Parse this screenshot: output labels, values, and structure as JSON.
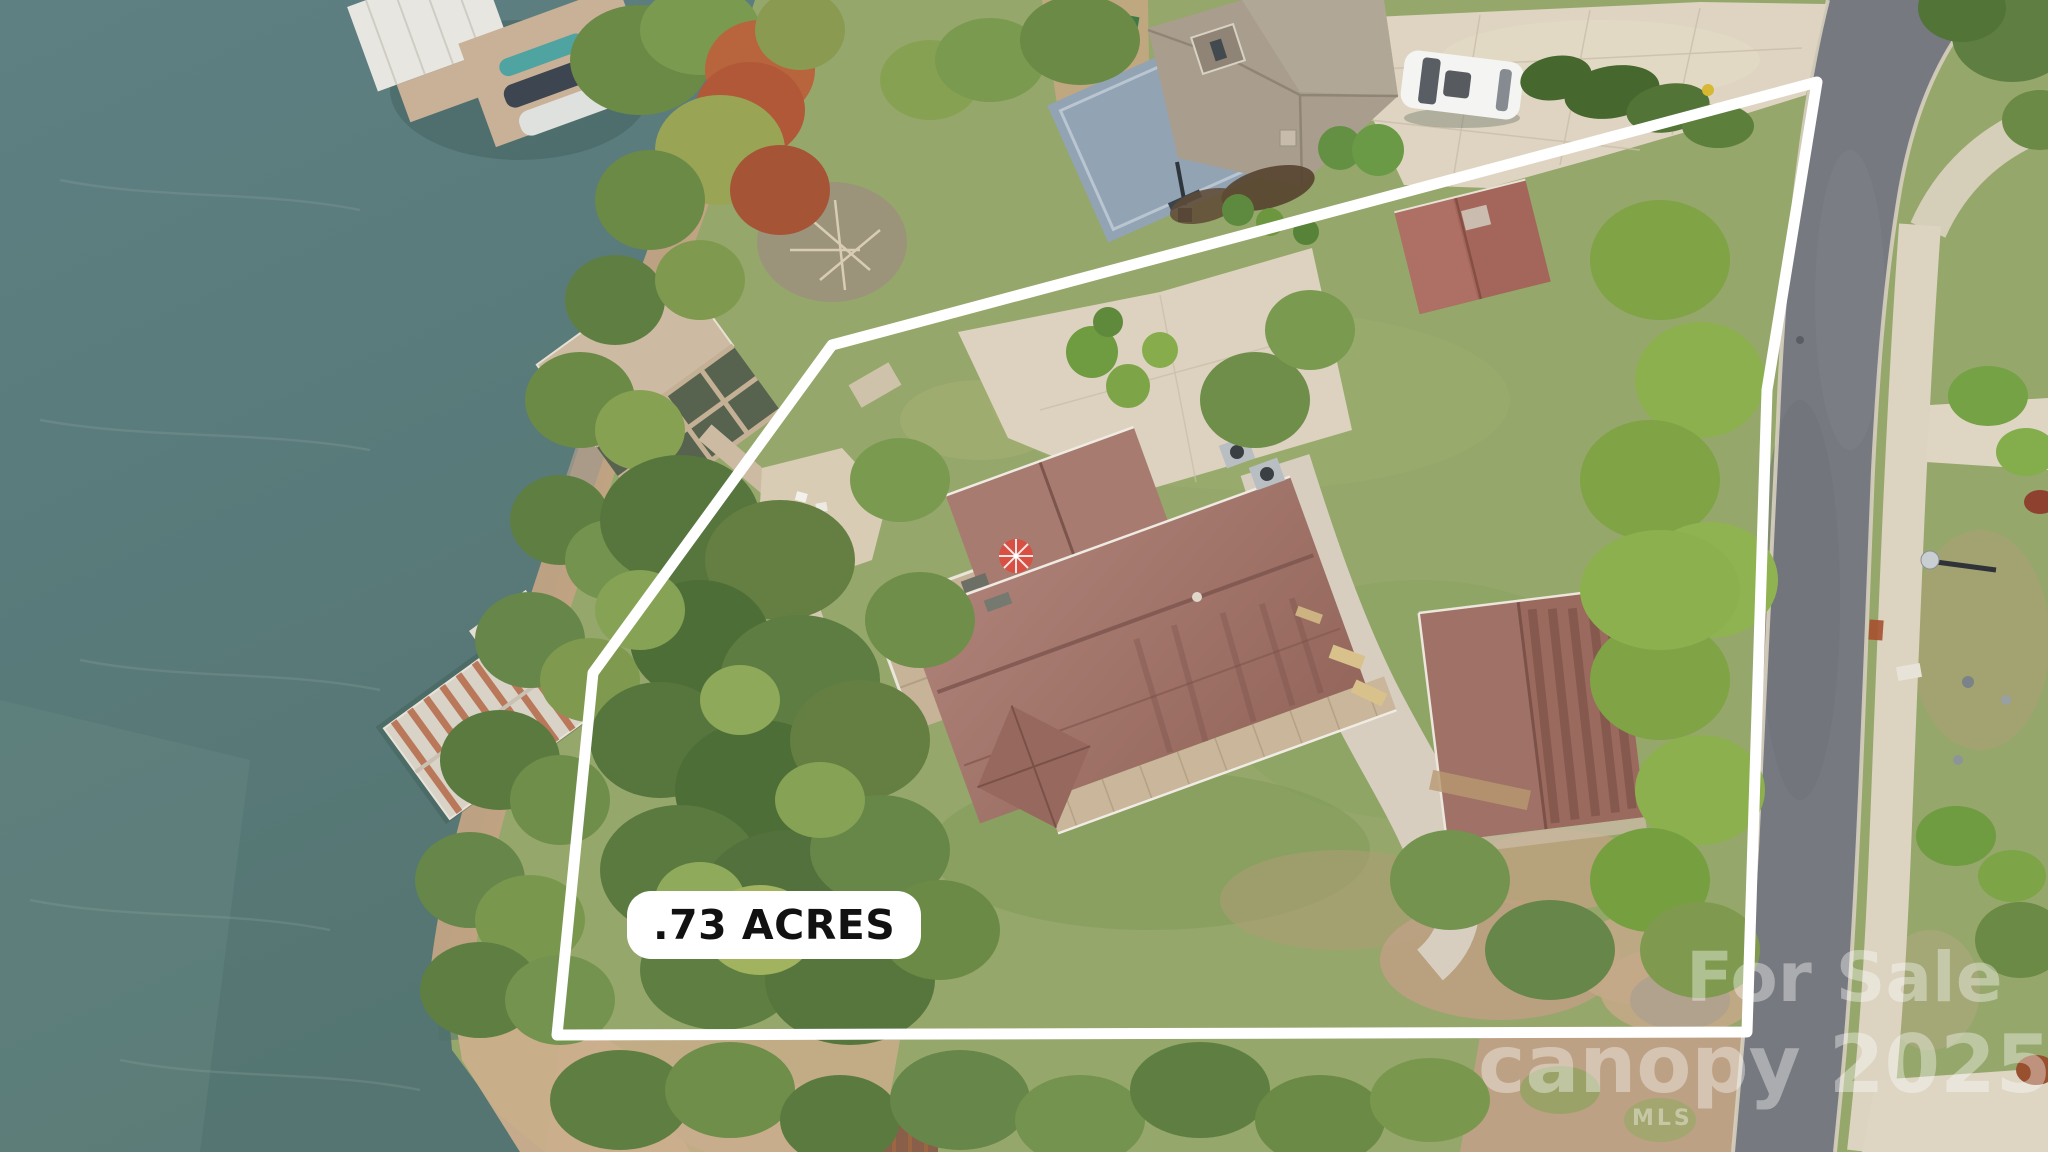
{
  "image": {
    "type": "aerial-drone-photo",
    "subject": "Lakefront residential lot outlined in white with lake, docks, main house, guest building, neighboring home, basketball court and street",
    "acreage_label": ".73 ACRES"
  },
  "watermark": {
    "line1": "For Sale",
    "brand": "canopy",
    "brand_sub": "MLS",
    "year": "2025"
  },
  "boundary": {
    "svg_points": "1817,82 832,345 593,673 557,1035 1747,1032 1767,390",
    "color": "#ffffff",
    "stroke_width": 11
  },
  "colors": {
    "water": "#5d7f7e",
    "shore_sand": "#c2a383",
    "lawn": "#93a768",
    "tree_green": "#5f7f42",
    "autumn_red": "#b05838",
    "main_roof": "#a3766c",
    "guest_roof": "#9a6a5f",
    "neighbor_roof": "#a99e8d",
    "road_asphalt": "#76797f",
    "concrete": "#ddd3c0",
    "deck_wood": "#c6b398",
    "court_blue": "#92a3b4",
    "umbrella_red": "#d85043",
    "label_bg": "#ffffff",
    "label_text": "#111111",
    "watermark_text": "#ffffff"
  }
}
